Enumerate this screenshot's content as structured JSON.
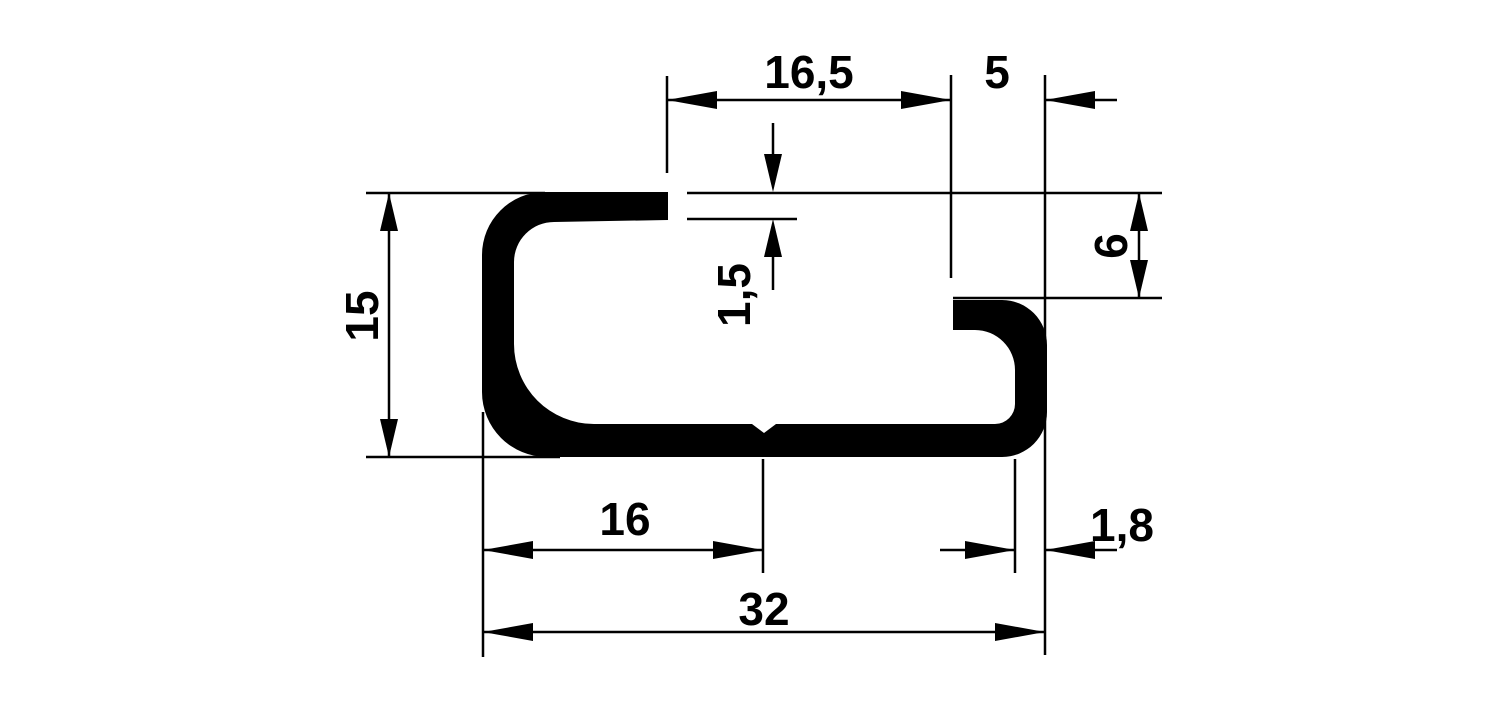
{
  "drawing": {
    "kind": "technical-dimension-drawing",
    "subject": "c-profile-rail-cross-section",
    "background_color": "#ffffff",
    "ink_color": "#000000",
    "unit_style": "decimal-comma-millimeters",
    "labels": {
      "top_opening_width": "16,5",
      "lip_to_edge": "5",
      "material_thickness": "1,5",
      "lip_height": "6",
      "profile_height": "15",
      "left_to_center": "16",
      "lip_material_thickness": "1,8",
      "profile_width": "32"
    }
  }
}
